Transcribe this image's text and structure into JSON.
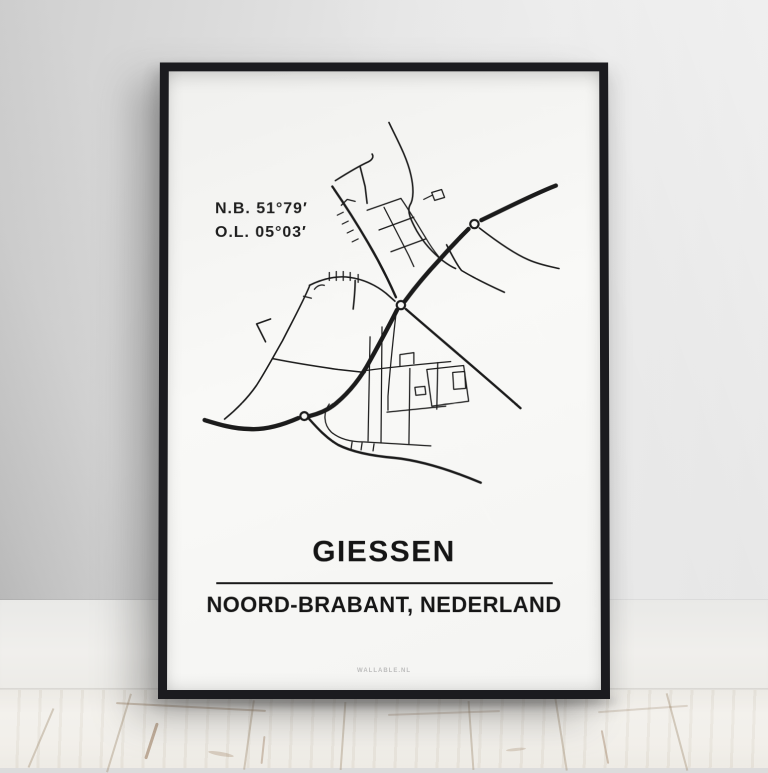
{
  "poster": {
    "coordinates": {
      "latitude_label": "N.B. 51°79′",
      "longitude_label": "O.L. 05°03′"
    },
    "title": "GIESSEN",
    "subtitle": "NOORD-BRABANT, NEDERLAND",
    "brand": "WALLABLE.NL"
  },
  "map": {
    "style": "minimalist black road network on white",
    "roundabouts_count": 3
  },
  "colors": {
    "frame": "#1b1b1f",
    "paper": "#f7f7f5",
    "map_stroke": "#1b1b1b",
    "text": "#161616",
    "brand_text": "#bcbcbc",
    "wall": "#dedede",
    "baseboard": "#efeeec",
    "floor": "#ece9e2"
  }
}
